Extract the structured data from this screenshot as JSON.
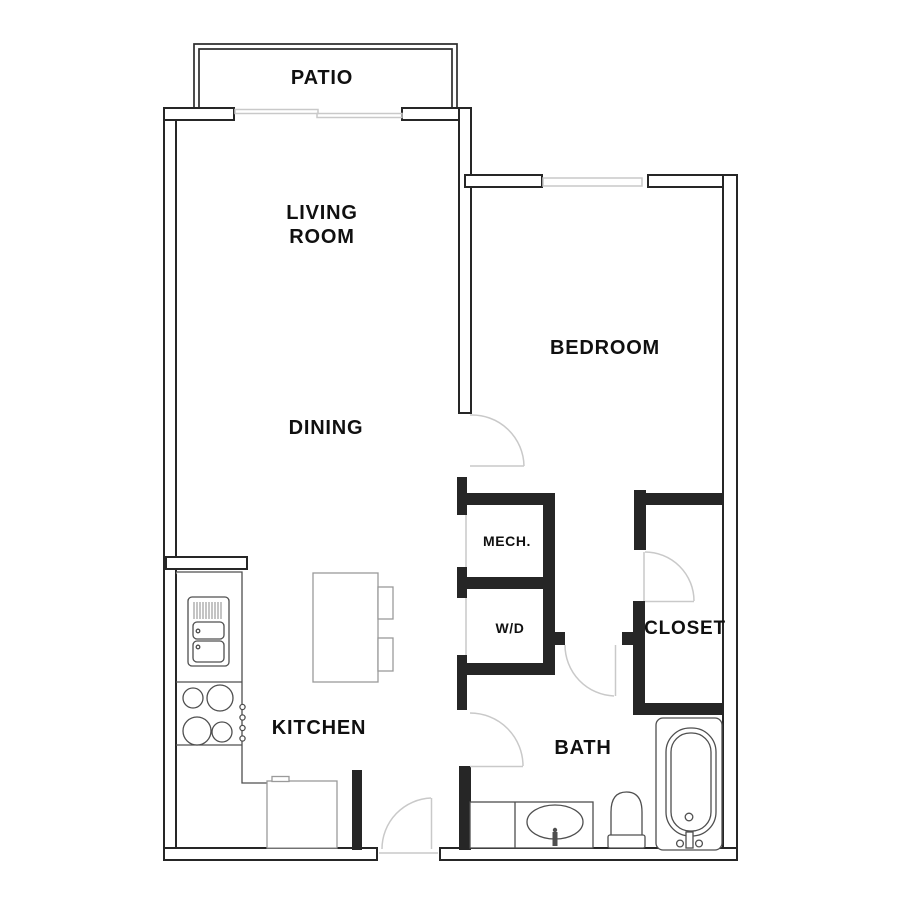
{
  "plan_type": "apartment floor plan, one bedroom one bath",
  "rooms": {
    "patio": {
      "label": "PATIO"
    },
    "living": {
      "line1": "LIVING",
      "line2": "ROOM"
    },
    "dining": {
      "label": "DINING"
    },
    "bedroom": {
      "label": "BEDROOM"
    },
    "mech": {
      "label": "MECH."
    },
    "wd": {
      "label": "W/D"
    },
    "closet": {
      "label": "CLOSET"
    },
    "kitchen": {
      "label": "KITCHEN"
    },
    "bath": {
      "label": "BATH"
    }
  },
  "fixtures": [
    "patio-sliding-door",
    "bedroom-window",
    "kitchen-counter",
    "kitchen-sink",
    "range-cooktop",
    "range-knobs",
    "kitchen-island",
    "bar-stool",
    "bar-stool",
    "under-counter-appliance",
    "entry-door",
    "bedroom-door",
    "bath-door",
    "bath-corridor-door",
    "closet-door",
    "vanity",
    "vanity-sink",
    "toilet",
    "bathtub"
  ],
  "colors": {
    "background": "#ffffff",
    "wall": "#262626",
    "door_swing": "#c9c9c9",
    "fixture_outline": "#4f4f4f",
    "fixture_light": "#9a9a9a",
    "label_text": "#101010"
  }
}
